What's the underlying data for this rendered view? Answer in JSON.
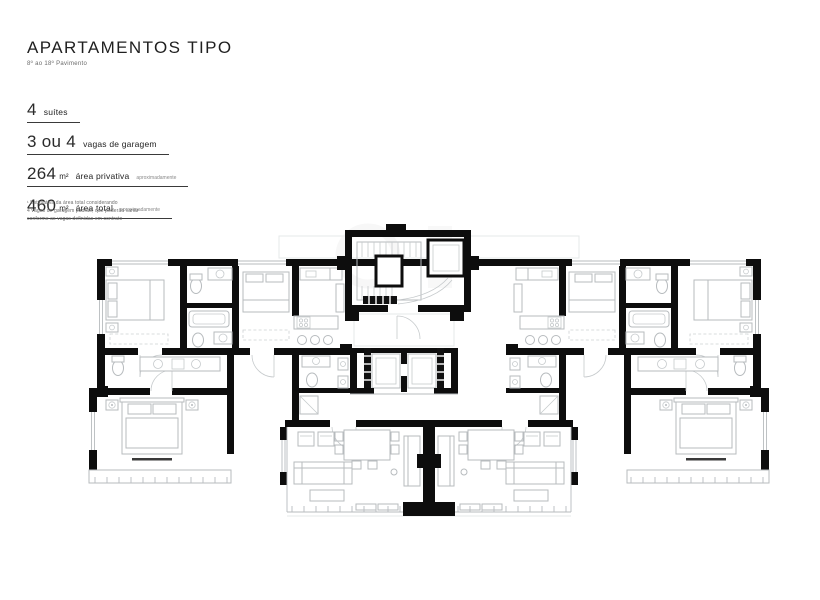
{
  "header": {
    "title": "APARTAMENTOS TIPO",
    "subtitle": "8º ao 18º Pavimento"
  },
  "specs": [
    {
      "value": "4",
      "unit": "",
      "label": "suítes",
      "note": ""
    },
    {
      "value": "3 ou 4",
      "unit": "",
      "label": "vagas de garagem",
      "note": ""
    },
    {
      "value": "264",
      "unit": "m²",
      "label": "área privativa",
      "note": "aproximadamente"
    },
    {
      "value": "460",
      "unit": "m²",
      "label": "área total",
      "note": "aproximadamente"
    }
  ],
  "footnote": {
    "line1": "¹ Estimativa da área total considerando",
    "line2": "4 vagas de garagem padrão, que poderão variar",
    "line3": "conforme as vagas definidas em contrato"
  },
  "colors": {
    "wall": "#0d0d0d",
    "furniture": "#b7bbbe",
    "text": "#2a2a2a"
  }
}
